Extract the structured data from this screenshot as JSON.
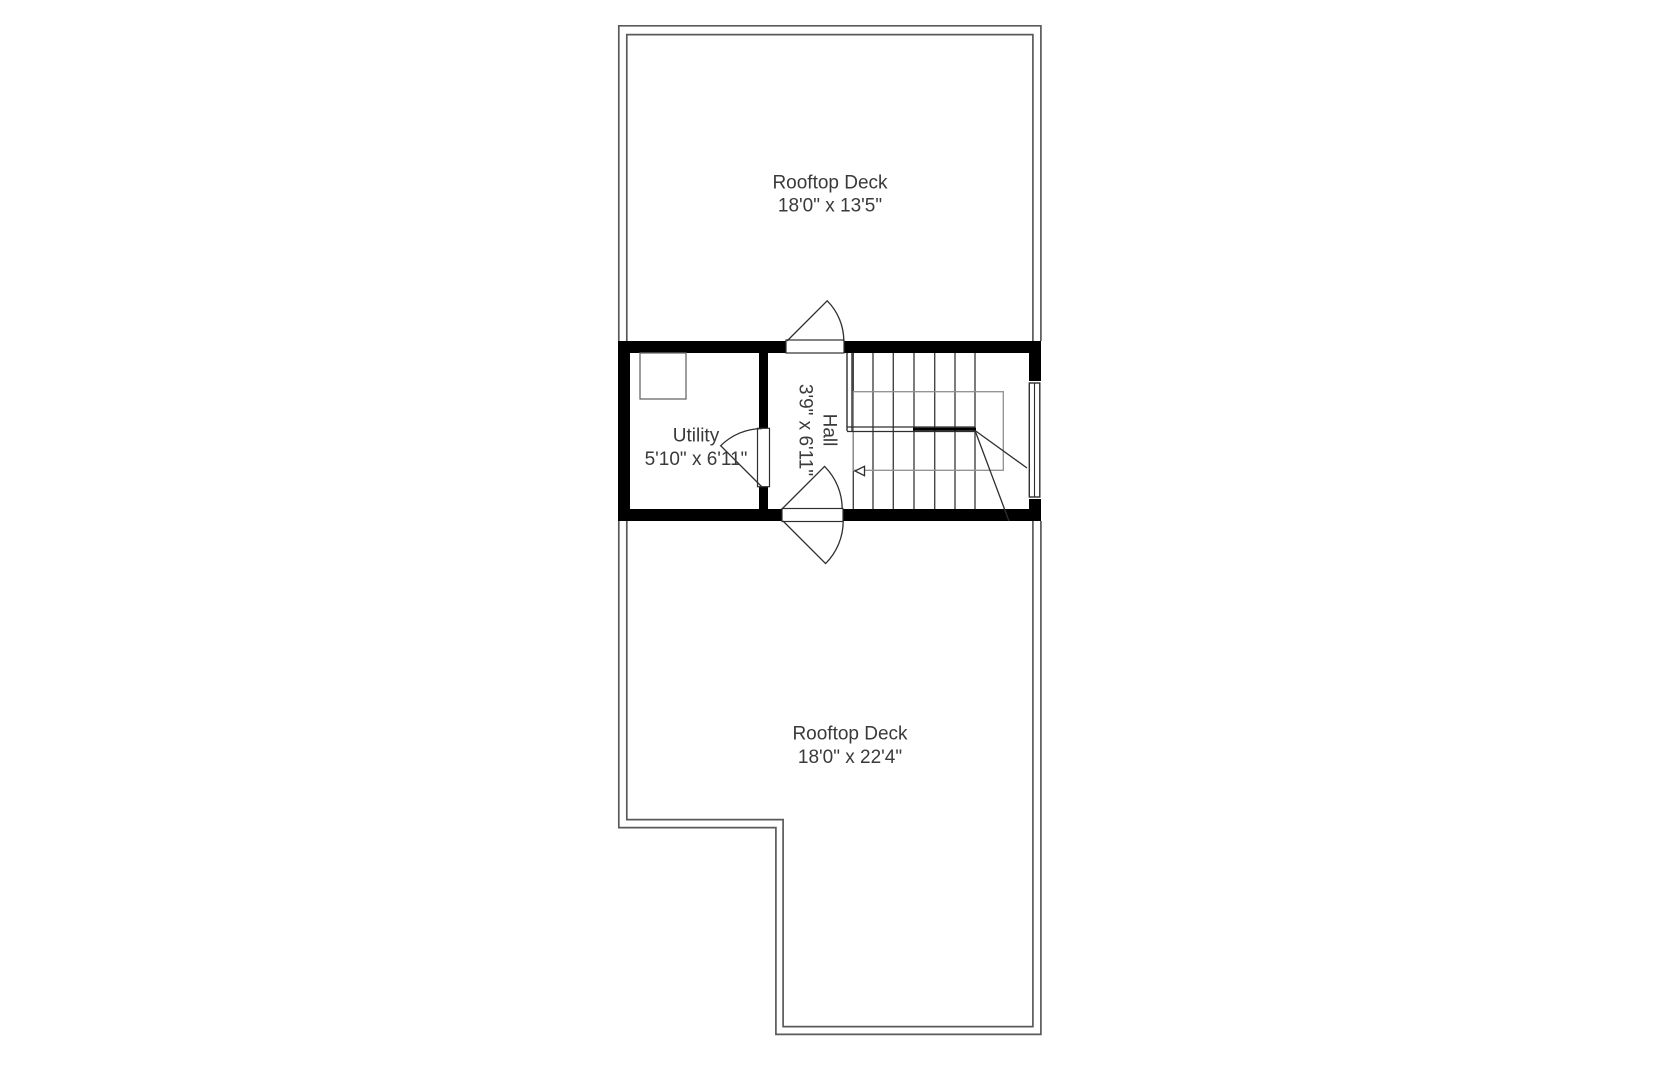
{
  "floorplan": {
    "type": "rooftop floor plan",
    "rooms": {
      "deck_top": {
        "name": "Rooftop Deck",
        "dims": "18'0\" x 13'5\""
      },
      "utility": {
        "name": "Utility",
        "dims": "5'10\" x 6'11\""
      },
      "hall": {
        "name": "Hall",
        "dims": "3'9\" x 6'11\""
      },
      "deck_bottom": {
        "name": "Rooftop Deck",
        "dims": "18'0\" x 22'4\""
      }
    },
    "symbols": {
      "staircase": "winder staircase with center railing and left direction arrow",
      "doors": [
        "top-wall swing door",
        "bottom-wall double swing door",
        "utility swing door"
      ],
      "window": "right wall window",
      "fixture": "utility corner fixture"
    },
    "colors": {
      "background": "#ffffff",
      "wall": "#000000",
      "boundary_line": "#5a5a5a",
      "detail_line": "#2f2f2f",
      "light_line": "#8f8f8f",
      "text": "#3a3a3a"
    }
  }
}
